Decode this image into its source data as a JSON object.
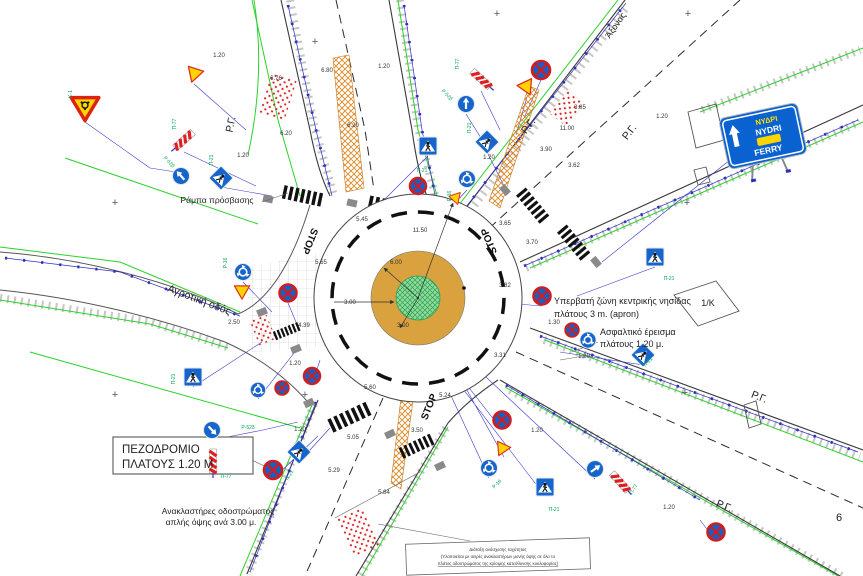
{
  "page": {
    "number": "6"
  },
  "colors": {
    "sign_blue": "#1565cd",
    "sign_red": "#d41c1c",
    "sign_yellow": "#ffd400",
    "apron": "#d9a23f",
    "island_green": "#8fdc9e",
    "line_green": "#2bd12b",
    "line_blue": "#2f2fbf",
    "dim": "#333333",
    "code_green": "#00a550"
  },
  "labels": [
    {
      "text": "1.20",
      "x": 219,
      "y": 57,
      "name": "dim"
    },
    {
      "text": "6.76",
      "x": 276,
      "y": 80,
      "name": "dim"
    },
    {
      "text": "6.80",
      "x": 327,
      "y": 72,
      "name": "dim"
    },
    {
      "text": "1.20",
      "x": 384,
      "y": 68,
      "name": "dim"
    },
    {
      "text": "6.20",
      "x": 286,
      "y": 135,
      "name": "dim"
    },
    {
      "text": "6.20",
      "x": 353,
      "y": 127,
      "name": "dim"
    },
    {
      "text": "1.20",
      "x": 243,
      "y": 157,
      "name": "dim"
    },
    {
      "text": "5.45",
      "x": 362,
      "y": 221,
      "name": "dim"
    },
    {
      "text": "11.50",
      "x": 420,
      "y": 232,
      "name": "dim"
    },
    {
      "text": "6.00",
      "x": 396,
      "y": 264,
      "name": "dim"
    },
    {
      "text": "3.00",
      "x": 350,
      "y": 304,
      "name": "dim"
    },
    {
      "text": "3.00",
      "x": 403,
      "y": 327,
      "name": "dim"
    },
    {
      "text": "5.65",
      "x": 321,
      "y": 264,
      "name": "dim"
    },
    {
      "text": "3.65",
      "x": 505,
      "y": 225,
      "name": "dim"
    },
    {
      "text": "3.70",
      "x": 532,
      "y": 244,
      "name": "dim"
    },
    {
      "text": "3.90",
      "x": 546,
      "y": 151,
      "name": "dim"
    },
    {
      "text": "11.00",
      "x": 567,
      "y": 130,
      "name": "dim"
    },
    {
      "text": "3.85",
      "x": 580,
      "y": 109,
      "name": "dim"
    },
    {
      "text": "3.62",
      "x": 574,
      "y": 167,
      "name": "dim"
    },
    {
      "text": "1.20",
      "x": 662,
      "y": 118,
      "name": "dim"
    },
    {
      "text": "1.20",
      "x": 489,
      "y": 159,
      "name": "dim"
    },
    {
      "text": "3.82",
      "x": 505,
      "y": 287,
      "name": "dim"
    },
    {
      "text": "3.31",
      "x": 500,
      "y": 357,
      "name": "dim"
    },
    {
      "text": "4.39",
      "x": 304,
      "y": 327,
      "name": "dim"
    },
    {
      "text": "2.50",
      "x": 234,
      "y": 324,
      "name": "dim"
    },
    {
      "text": "1.20",
      "x": 295,
      "y": 365,
      "name": "dim"
    },
    {
      "text": "1.30",
      "x": 554,
      "y": 324,
      "name": "dim"
    },
    {
      "text": "1.20",
      "x": 584,
      "y": 358,
      "name": "dim"
    },
    {
      "text": "5.60",
      "x": 370,
      "y": 389,
      "name": "dim"
    },
    {
      "text": "5.24",
      "x": 445,
      "y": 397,
      "name": "dim"
    },
    {
      "text": "5.05",
      "x": 353,
      "y": 439,
      "name": "dim"
    },
    {
      "text": "3.50",
      "x": 417,
      "y": 432,
      "name": "dim"
    },
    {
      "text": "5.29",
      "x": 334,
      "y": 472,
      "name": "dim"
    },
    {
      "text": "5.84",
      "x": 384,
      "y": 494,
      "name": "dim"
    },
    {
      "text": "1.20",
      "x": 537,
      "y": 432,
      "name": "dim"
    },
    {
      "text": "1.20",
      "x": 669,
      "y": 509,
      "name": "dim"
    },
    {
      "text": "1.20",
      "x": 300,
      "y": 431,
      "name": "dim"
    },
    {
      "text": "Π-77",
      "x": 176,
      "y": 124,
      "r": -90,
      "fs": 5,
      "c": "#00a550",
      "name": "sign-code"
    },
    {
      "text": "Ρ-52β",
      "x": 168,
      "y": 163,
      "r": 45,
      "fs": 5,
      "c": "#00a550",
      "name": "sign-code"
    },
    {
      "text": "Π-21",
      "x": 213,
      "y": 160,
      "r": -90,
      "fs": 5,
      "c": "#00a550",
      "name": "sign-code"
    },
    {
      "text": "Κ-1",
      "x": 72,
      "y": 94,
      "r": -90,
      "fs": 5,
      "c": "#00a550",
      "name": "sign-code"
    },
    {
      "text": "Π-21",
      "x": 422,
      "y": 172,
      "fs": 5,
      "c": "#00a550",
      "name": "sign-code"
    },
    {
      "text": "Π-21",
      "x": 471,
      "y": 128,
      "r": -90,
      "fs": 5,
      "c": "#00a550",
      "name": "sign-code"
    },
    {
      "text": "Π-77",
      "x": 459,
      "y": 64,
      "r": -90,
      "fs": 5,
      "c": "#00a550",
      "name": "sign-code"
    },
    {
      "text": "Ρ-52β",
      "x": 446,
      "y": 96,
      "r": 45,
      "fs": 5,
      "c": "#00a550",
      "name": "sign-code"
    },
    {
      "text": "Ρ-16",
      "x": 451,
      "y": 196,
      "r": -90,
      "fs": 5,
      "c": "#00a550",
      "name": "sign-code"
    },
    {
      "text": "Π-21",
      "x": 669,
      "y": 280,
      "fs": 5,
      "c": "#00a550",
      "name": "sign-code"
    },
    {
      "text": "Π-21",
      "x": 649,
      "y": 363,
      "r": -45,
      "fs": 5,
      "c": "#00a550",
      "name": "sign-code"
    },
    {
      "text": "Π-21",
      "x": 554,
      "y": 511,
      "fs": 5,
      "c": "#00a550",
      "name": "sign-code"
    },
    {
      "text": "Π-77",
      "x": 635,
      "y": 490,
      "r": -60,
      "fs": 5,
      "c": "#00a550",
      "name": "sign-code"
    },
    {
      "text": "Ρ-52δ",
      "x": 248,
      "y": 429,
      "fs": 5,
      "c": "#00a550",
      "name": "sign-code"
    },
    {
      "text": "Π-77",
      "x": 226,
      "y": 478,
      "fs": 5,
      "c": "#00a550",
      "name": "sign-code"
    },
    {
      "text": "Π-21",
      "x": 175,
      "y": 379,
      "r": -90,
      "fs": 5,
      "c": "#00a550",
      "name": "sign-code"
    },
    {
      "text": "Π-21",
      "x": 291,
      "y": 476,
      "r": -60,
      "fs": 5,
      "c": "#00a550",
      "name": "sign-code"
    },
    {
      "text": "Ρ-16",
      "x": 227,
      "y": 263,
      "r": -90,
      "fs": 5,
      "c": "#00a550",
      "name": "sign-code"
    },
    {
      "text": "Ρ-16",
      "x": 498,
      "y": 485,
      "r": -45,
      "fs": 5,
      "c": "#00a550",
      "name": "sign-code"
    },
    {
      "text": "Ράμπα πρόσβασης",
      "x": 217,
      "y": 203,
      "fs": 8.5,
      "c": "#222",
      "name": "note-access-ramp"
    },
    {
      "text": "Αγροτική οδός",
      "x": 198,
      "y": 303,
      "r": 21,
      "fs": 10.5,
      "c": "#222",
      "name": "road-name-rural"
    },
    {
      "text": "ΠΕΖΟΔΡΟΜΙΟ",
      "x": 122,
      "y": 453,
      "fs": 11.5,
      "a": "start",
      "c": "#222",
      "name": "note-sidewalk-line1"
    },
    {
      "text": "ΠΛΑΤΟΥΣ 1.20 M",
      "x": 122,
      "y": 468,
      "fs": 11.5,
      "a": "start",
      "c": "#222",
      "name": "note-sidewalk-line2"
    },
    {
      "text": "Ανακλαστήρες οδοστρώματος",
      "x": 218,
      "y": 514,
      "fs": 8.5,
      "c": "#222",
      "name": "note-reflectors-line1"
    },
    {
      "text": "απλής όψης ανά 3.00 μ.",
      "x": 211,
      "y": 525,
      "fs": 8.5,
      "c": "#222",
      "name": "note-reflectors-line2"
    },
    {
      "text": "Υπερβατή ζώνη κεντρικής νησίδας",
      "x": 554,
      "y": 304,
      "fs": 9,
      "a": "start",
      "c": "#222",
      "name": "note-apron-line1"
    },
    {
      "text": "πλάτους 3 m. (apron)",
      "x": 554,
      "y": 317,
      "fs": 9,
      "a": "start",
      "c": "#222",
      "name": "note-apron-line2"
    },
    {
      "text": "Ασφαλτικό έρεισμα",
      "x": 600,
      "y": 335,
      "fs": 9,
      "a": "start",
      "c": "#222",
      "name": "note-shoulder-line1"
    },
    {
      "text": "πλάτους 1.20 μ.",
      "x": 600,
      "y": 347,
      "fs": 9,
      "a": "start",
      "c": "#222",
      "name": "note-shoulder-line2"
    },
    {
      "text": "1/K",
      "x": 708,
      "y": 306,
      "fs": 9,
      "c": "#222",
      "name": "block-label"
    },
    {
      "text": "Άξονας",
      "x": 618,
      "y": 27,
      "r": -55,
      "fs": 9,
      "c": "#222",
      "name": "axis-label"
    },
    {
      "text": "6",
      "x": 839,
      "y": 521,
      "fs": 11,
      "c": "#222",
      "name": "page-number"
    },
    {
      "text": "Ρ.Γ.",
      "x": 234,
      "y": 125,
      "r": -78,
      "fs": 10.5,
      "c": "#222",
      "name": "building-line-label"
    },
    {
      "text": "Ρ.Γ.",
      "x": 531,
      "y": 128,
      "r": -52,
      "fs": 10.5,
      "c": "#222",
      "name": "building-line-label"
    },
    {
      "text": "Ρ.Γ.",
      "x": 632,
      "y": 134,
      "r": -52,
      "fs": 10.5,
      "c": "#222",
      "name": "building-line-label"
    },
    {
      "text": "Ρ.Γ.",
      "x": 758,
      "y": 400,
      "r": 22,
      "fs": 10.5,
      "c": "#222",
      "name": "building-line-label"
    },
    {
      "text": "Ρ.Γ.",
      "x": 723,
      "y": 509,
      "r": 22,
      "fs": 10.5,
      "c": "#222",
      "name": "building-line-label"
    },
    {
      "text": "STOP",
      "x": 307,
      "y": 240,
      "r": 112,
      "fs": 10,
      "w": 1,
      "c": "#111",
      "name": "stop-marking"
    },
    {
      "text": "STOP",
      "x": 492,
      "y": 240,
      "r": -112,
      "fs": 10,
      "w": 1,
      "c": "#111",
      "name": "stop-marking"
    },
    {
      "text": "STOP",
      "x": 432,
      "y": 408,
      "r": -68,
      "fs": 10,
      "w": 1,
      "c": "#111",
      "name": "stop-marking"
    },
    {
      "text": "+",
      "x": 315,
      "y": 45,
      "fs": 11,
      "c": "#555",
      "name": "grid-cross"
    },
    {
      "text": "+",
      "x": 497,
      "y": 17,
      "fs": 11,
      "c": "#555",
      "name": "grid-cross"
    },
    {
      "text": "+",
      "x": 688,
      "y": 17,
      "fs": 11,
      "c": "#555",
      "name": "grid-cross"
    },
    {
      "text": "+",
      "x": 687,
      "y": 206,
      "fs": 11,
      "c": "#555",
      "name": "grid-cross"
    },
    {
      "text": "+",
      "x": 115,
      "y": 206,
      "fs": 11,
      "c": "#555",
      "name": "grid-cross"
    },
    {
      "text": "+",
      "x": 115,
      "y": 398,
      "fs": 11,
      "c": "#555",
      "name": "grid-cross"
    },
    {
      "text": "+",
      "x": 305,
      "y": 398,
      "fs": 11,
      "c": "#555",
      "name": "grid-cross"
    },
    {
      "text": "+",
      "x": 685,
      "y": 396,
      "fs": 11,
      "c": "#555",
      "name": "grid-cross"
    },
    {
      "text": "ΝΥΔΡΙ",
      "x": 767,
      "y": 123,
      "r": -12,
      "fs": 7.5,
      "w": 1,
      "c": "#ffe000",
      "name": "nydri-sign-line1"
    },
    {
      "text": "NYDRI",
      "x": 769,
      "y": 133,
      "r": -12,
      "fs": 8.5,
      "w": 1,
      "c": "#ffffff",
      "name": "nydri-sign-line2"
    },
    {
      "text": "FERRY",
      "x": 769,
      "y": 153,
      "r": -12,
      "fs": 8.5,
      "w": 1,
      "c": "#ffffff",
      "name": "nydri-sign-line3"
    },
    {
      "text": "Διάταξη ανάσχεσης ταχύτητας",
      "x": 498,
      "y": 551,
      "fs": 4.3,
      "c": "#333",
      "name": "note-box-line1"
    },
    {
      "text": "(Υλοποιείται με σειρές ανακλαστήρων μονής όψης σε όλο το",
      "x": 498,
      "y": 558,
      "fs": 4.3,
      "c": "#333",
      "name": "note-box-line2"
    },
    {
      "text": "πλάτος οδοστρώματος της κρίσιμης κατεύθυνσης κυκλοφορίας)",
      "x": 498,
      "y": 565,
      "fs": 4.3,
      "c": "#333",
      "u": 1,
      "name": "note-box-line3"
    }
  ],
  "signs": [
    {
      "t": "yieldg",
      "x": 85,
      "y": 108,
      "s": 1.15,
      "name": "roundabout-warning"
    },
    {
      "t": "tri",
      "x": 194,
      "y": 75,
      "r": 18,
      "name": "warning-triangle"
    },
    {
      "t": "stripe",
      "x": 184,
      "y": 140,
      "r": 48,
      "name": "hazard-marker"
    },
    {
      "t": "arrow",
      "x": 181,
      "y": 176,
      "r": -42,
      "name": "mandatory-direction"
    },
    {
      "t": "ped",
      "x": 221,
      "y": 178,
      "r": 45,
      "s": 0.95,
      "name": "pedestrian-crossing"
    },
    {
      "t": "ped",
      "x": 428,
      "y": 146,
      "name": "pedestrian-crossing"
    },
    {
      "t": "ped",
      "x": 487,
      "y": 142,
      "r": 45,
      "s": 0.95,
      "name": "pedestrian-crossing"
    },
    {
      "t": "stripe",
      "x": 481,
      "y": 79,
      "r": -48,
      "name": "hazard-marker"
    },
    {
      "t": "arrow",
      "x": 466,
      "y": 104,
      "name": "mandatory-direction"
    },
    {
      "t": "tri",
      "x": 527,
      "y": 88,
      "r": -25,
      "name": "warning-triangle"
    },
    {
      "t": "nostop",
      "x": 541,
      "y": 70,
      "name": "no-stopping"
    },
    {
      "t": "nostop",
      "x": 418,
      "y": 186,
      "s": 0.9,
      "name": "no-stopping"
    },
    {
      "t": "rbt",
      "x": 467,
      "y": 179,
      "name": "roundabout-mandatory"
    },
    {
      "t": "tri",
      "x": 456,
      "y": 199,
      "r": -18,
      "s": 0.75,
      "name": "warning-triangle"
    },
    {
      "t": "rbt",
      "x": 243,
      "y": 272,
      "name": "roundabout-mandatory"
    },
    {
      "t": "tri",
      "x": 242,
      "y": 292,
      "s": 0.95,
      "name": "warning-triangle"
    },
    {
      "t": "nostop",
      "x": 288,
      "y": 293,
      "s": 0.95,
      "name": "no-stopping"
    },
    {
      "t": "ped",
      "x": 193,
      "y": 377,
      "name": "pedestrian-crossing"
    },
    {
      "t": "rbt",
      "x": 258,
      "y": 390,
      "s": 0.9,
      "name": "roundabout-mandatory"
    },
    {
      "t": "nostop",
      "x": 282,
      "y": 388,
      "s": 0.75,
      "name": "no-stopping"
    },
    {
      "t": "nostop",
      "x": 312,
      "y": 376,
      "s": 0.9,
      "name": "no-stopping"
    },
    {
      "t": "arrow",
      "x": 212,
      "y": 430,
      "r": 137,
      "name": "mandatory-direction"
    },
    {
      "t": "stripe",
      "x": 213,
      "y": 461,
      "name": "hazard-marker"
    },
    {
      "t": "nostop",
      "x": 273,
      "y": 470,
      "name": "no-stopping"
    },
    {
      "t": "ped",
      "x": 299,
      "y": 452,
      "r": 45,
      "s": 0.95,
      "name": "pedestrian-crossing"
    },
    {
      "t": "nostop",
      "x": 502,
      "y": 420,
      "s": 0.95,
      "name": "no-stopping"
    },
    {
      "t": "tri",
      "x": 504,
      "y": 448,
      "r": -95,
      "s": 0.9,
      "name": "warning-triangle"
    },
    {
      "t": "rbt",
      "x": 489,
      "y": 468,
      "name": "roundabout-mandatory"
    },
    {
      "t": "ped",
      "x": 545,
      "y": 487,
      "name": "pedestrian-crossing"
    },
    {
      "t": "arrow",
      "x": 595,
      "y": 469,
      "r": 55,
      "name": "mandatory-direction"
    },
    {
      "t": "stripe",
      "x": 620,
      "y": 482,
      "r": -42,
      "name": "hazard-marker"
    },
    {
      "t": "nostop",
      "x": 716,
      "y": 532,
      "s": 0.95,
      "name": "no-stopping"
    },
    {
      "t": "ped",
      "x": 655,
      "y": 257,
      "name": "pedestrian-crossing"
    },
    {
      "t": "ped",
      "x": 643,
      "y": 355,
      "r": 45,
      "s": 0.95,
      "name": "pedestrian-crossing"
    },
    {
      "t": "nostop",
      "x": 542,
      "y": 296,
      "s": 0.95,
      "name": "no-stopping"
    },
    {
      "t": "nostop",
      "x": 572,
      "y": 330,
      "s": 0.75,
      "name": "no-stopping"
    },
    {
      "t": "rbt",
      "x": 588,
      "y": 340,
      "s": 0.95,
      "name": "roundabout-mandatory"
    }
  ]
}
